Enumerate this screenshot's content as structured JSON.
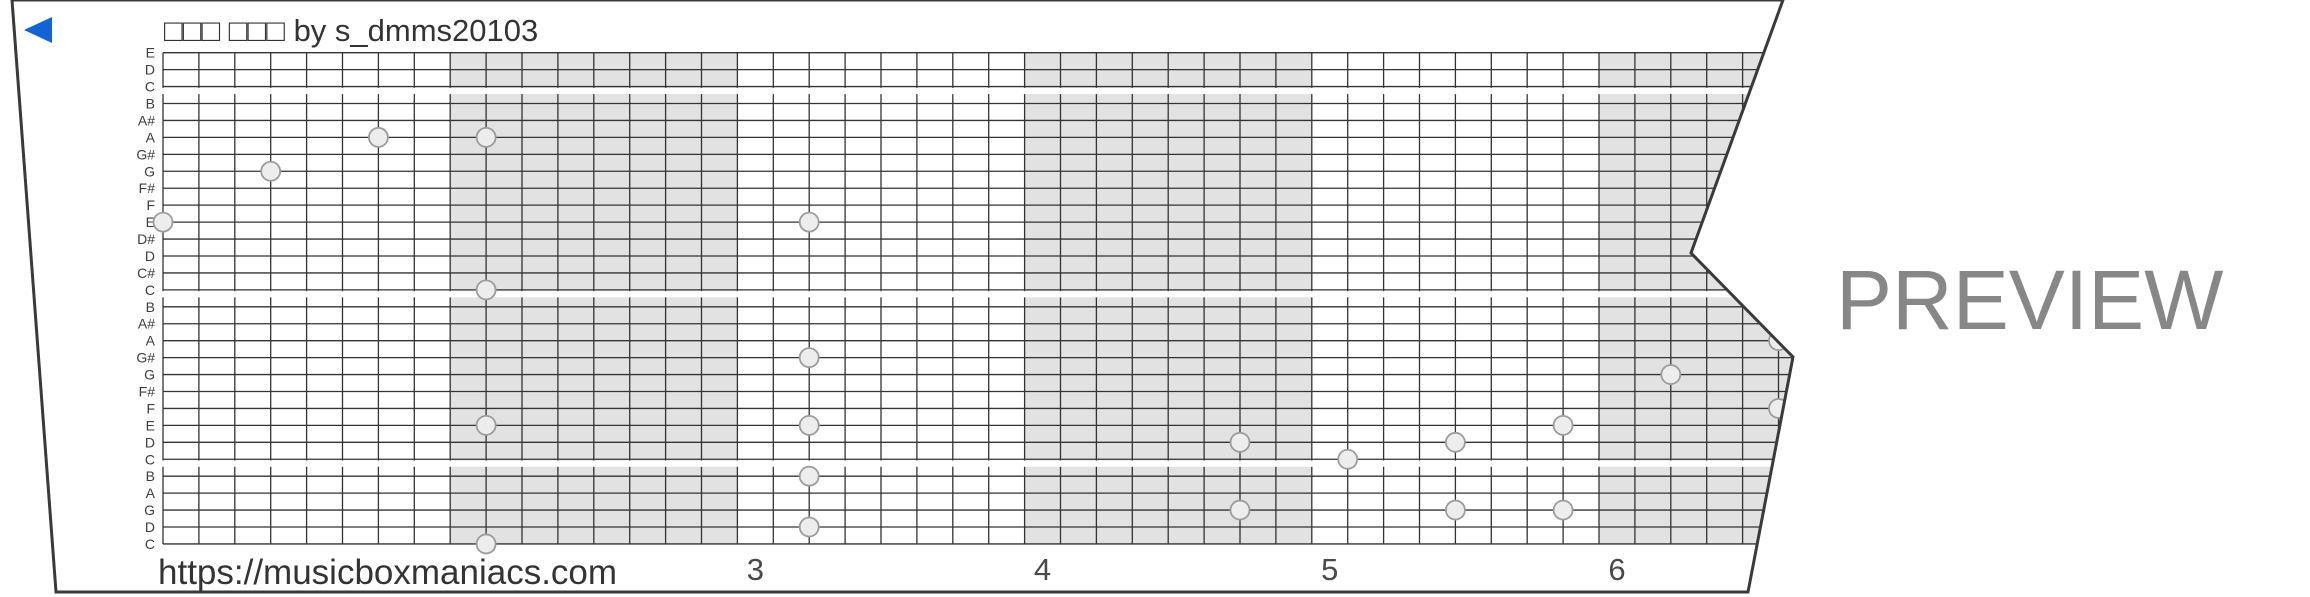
{
  "header": {
    "title": "□□□ □□□ by s_dmms20103"
  },
  "watermark": {
    "label": "PREVIEW"
  },
  "footer": {
    "url": "https://musicboxmaniacs.com"
  },
  "strip": {
    "row_labels": [
      "E",
      "D",
      "C",
      "B",
      "A#",
      "A",
      "G#",
      "G",
      "F#",
      "F",
      "E",
      "D#",
      "D",
      "C#",
      "C",
      "B",
      "A#",
      "A",
      "G#",
      "G",
      "F#",
      "F",
      "E",
      "D",
      "C",
      "B",
      "A",
      "G",
      "D",
      "C"
    ],
    "measure_numbers": [
      {
        "label": "3",
        "measure": 3
      },
      {
        "label": "4",
        "measure": 4
      },
      {
        "label": "5",
        "measure": 5
      },
      {
        "label": "6",
        "measure": 6
      }
    ],
    "shaded_measure_start_beats": [
      8,
      24,
      40
    ],
    "octave_break_lines": [
      2,
      14,
      24
    ],
    "notes": [
      {
        "beat": 0,
        "line": 10,
        "pitch": "E"
      },
      {
        "beat": 3,
        "line": 7,
        "pitch": "G"
      },
      {
        "beat": 6,
        "line": 5,
        "pitch": "A"
      },
      {
        "beat": 9,
        "line": 5,
        "pitch": "A"
      },
      {
        "beat": 9,
        "line": 14,
        "pitch": "C"
      },
      {
        "beat": 9,
        "line": 22,
        "pitch": "E"
      },
      {
        "beat": 9,
        "line": 29,
        "pitch": "C"
      },
      {
        "beat": 18,
        "line": 10,
        "pitch": "E"
      },
      {
        "beat": 18,
        "line": 18,
        "pitch": "G#"
      },
      {
        "beat": 18,
        "line": 22,
        "pitch": "E"
      },
      {
        "beat": 18,
        "line": 25,
        "pitch": "B"
      },
      {
        "beat": 18,
        "line": 28,
        "pitch": "D"
      },
      {
        "beat": 30,
        "line": 23,
        "pitch": "D"
      },
      {
        "beat": 30,
        "line": 27,
        "pitch": "G"
      },
      {
        "beat": 33,
        "line": 24,
        "pitch": "C"
      },
      {
        "beat": 36,
        "line": 23,
        "pitch": "D"
      },
      {
        "beat": 36,
        "line": 27,
        "pitch": "G"
      },
      {
        "beat": 39,
        "line": 22,
        "pitch": "E"
      },
      {
        "beat": 39,
        "line": 27,
        "pitch": "G"
      },
      {
        "beat": 42,
        "line": 19,
        "pitch": "G"
      },
      {
        "beat": 45,
        "line": 17,
        "pitch": "A"
      },
      {
        "beat": 45,
        "line": 21,
        "pitch": "F"
      }
    ],
    "colors": {
      "shading": "#e2e2e2",
      "grid_line": "#333333",
      "border": "#3a3a3a",
      "note_fill": "#ededed",
      "note_stroke": "#9c9c9c",
      "label_text": "#3d3d3d",
      "number_text": "#4a4a4a",
      "accent_blue": "#1163d6",
      "paper": "#ffffff"
    }
  }
}
